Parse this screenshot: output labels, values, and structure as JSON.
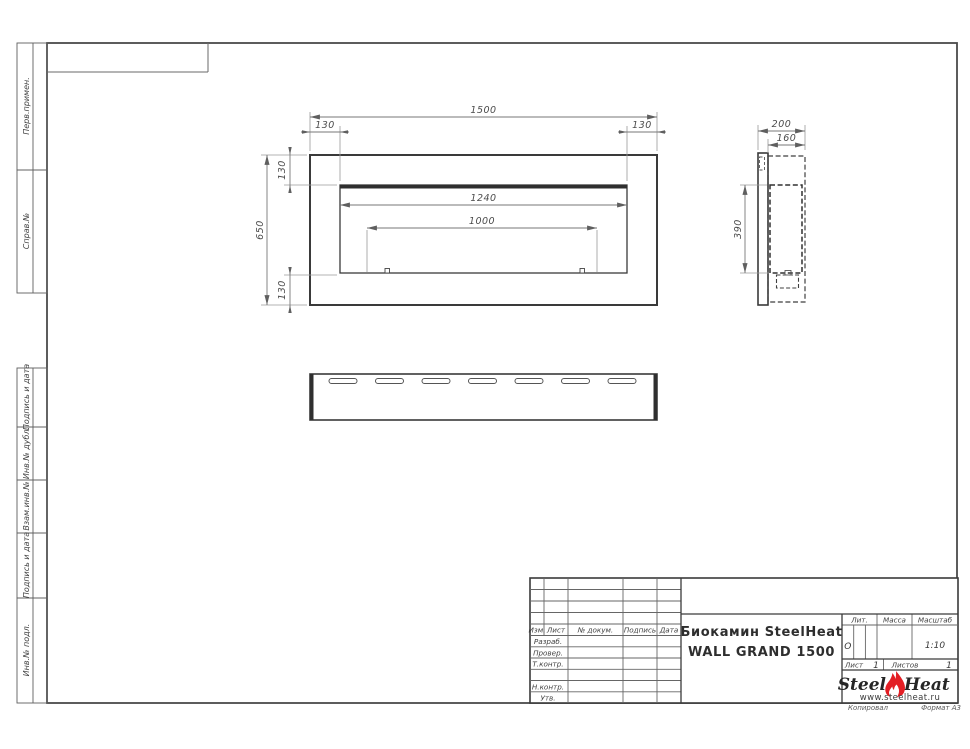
{
  "page": {
    "copied_label": "Копировал",
    "format_label": "Формат А3"
  },
  "left_margin": {
    "cells": [
      {
        "label": "Перв.примен."
      },
      {
        "label": "Справ.№"
      },
      {
        "label": "Подпись и дата"
      },
      {
        "label": "Инв.№ дубл."
      },
      {
        "label": "Взам.инв.№"
      },
      {
        "label": "Подпись и дата"
      },
      {
        "label": "Инв.№ подл."
      }
    ]
  },
  "views": {
    "front": {
      "dim_width": "1500",
      "dim_offset_left": "130",
      "dim_offset_right": "130",
      "dim_offset_top": "130",
      "dim_offset_bottom": "130",
      "dim_height": "650",
      "dim_opening_width": "1240",
      "dim_burner_length": "1000"
    },
    "side": {
      "dim_depth": "200",
      "dim_recess_depth": "160",
      "dim_opening_height": "390"
    }
  },
  "title_block": {
    "cols": {
      "izm": "Изм.",
      "list": "Лист",
      "doc": "№ докум.",
      "sign": "Подпись",
      "date": "Дата"
    },
    "rows": {
      "developed": "Разраб.",
      "checked": "Провер.",
      "tcontrol": "Т.контр.",
      "ncontrol": "Н.контр.",
      "approved": "Утв."
    },
    "title_line1": "Биокамин SteelHeat",
    "title_line2": "WALL GRAND 1500",
    "lit_label": "Лит.",
    "lit_value": "О",
    "mass_label": "Масса",
    "scale_label": "Масштаб",
    "scale_value": "1:10",
    "sheet_label": "Лист",
    "sheet_number": "1",
    "sheets_label": "Листов",
    "sheets_total": "1",
    "logo": {
      "word1": "Steel",
      "word2": "Heat",
      "site": "www.steelheat.ru",
      "flame_color": "#e31e24"
    }
  }
}
